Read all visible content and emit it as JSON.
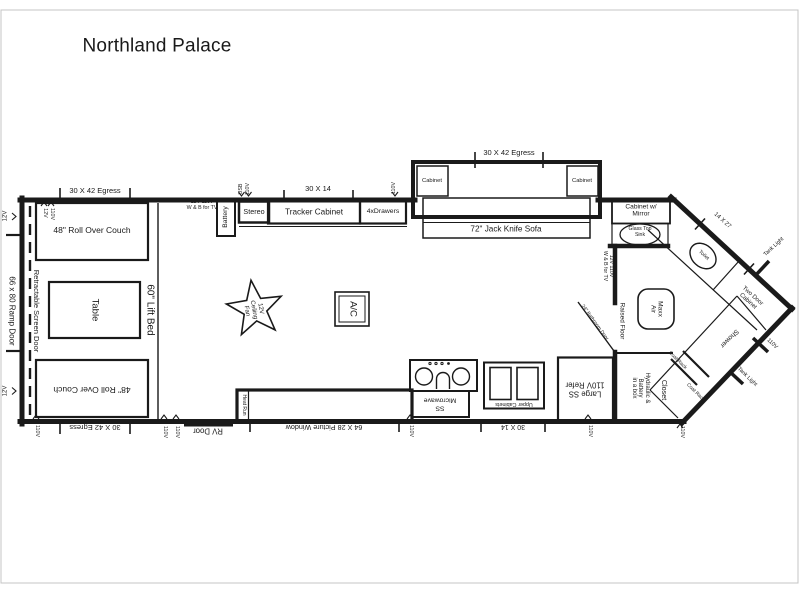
{
  "title": "Northland Palace",
  "colors": {
    "line": "#1a1a1a",
    "frame": "#c4c4c4",
    "bg": "#ffffff"
  },
  "living": {
    "roll_over_couch": "48\" Roll Over Couch",
    "table": "Table",
    "lift_bed": "60\" Lift Bed",
    "jack_knife_sofa": "72\" Jack Knife Sofa",
    "cabinet": "Cabinet",
    "tracker_cabinet": "Tracker Cabinet",
    "drawers": "4xDrawers",
    "stereo": "Stereo",
    "battery": "Battery",
    "ceiling_fan": "12V\nCeiling\nFan",
    "ac": "A/C"
  },
  "kitchen": {
    "microwave": "SS\nMicrowave",
    "upper_cabinets": "Upper Cabinets",
    "refrigerator": "Large SS\n110V Refer",
    "heat_run": "Heat Run",
    "rv_door": "RV Door"
  },
  "bathroom": {
    "cabinet_mirror": "Cabinet w/\nMirror",
    "glass_top_sink": "Glass Top\nSink",
    "toilet": "Toilet",
    "shower": "Shower",
    "maxx_air": "Maxx\nAir",
    "raised_floor": "Raised Floor",
    "bathroom_door": "24\" Bathroom Door",
    "two_door_cabinet": "Two Door\nCabinet",
    "closet": "Closet",
    "hydraulic_battery": "Hydraulic &\nBattery\nin a box",
    "coat_rack": "Coat Rack"
  },
  "exterior": {
    "ramp_door": "66 x 80 Ramp Door",
    "screen_door": "Retractable Screen Door",
    "egress_30x42": "30 X 42 Egress",
    "window_30x14": "30 X 14",
    "picture_window": "64 X 28 Picture Window",
    "window_14x27": "14 X 27",
    "tank_light": "Tank Light"
  },
  "hookups": {
    "v12": "12V",
    "v110": "110V",
    "usb": "USB",
    "tv": "12V 110V\nW & B for TV"
  }
}
